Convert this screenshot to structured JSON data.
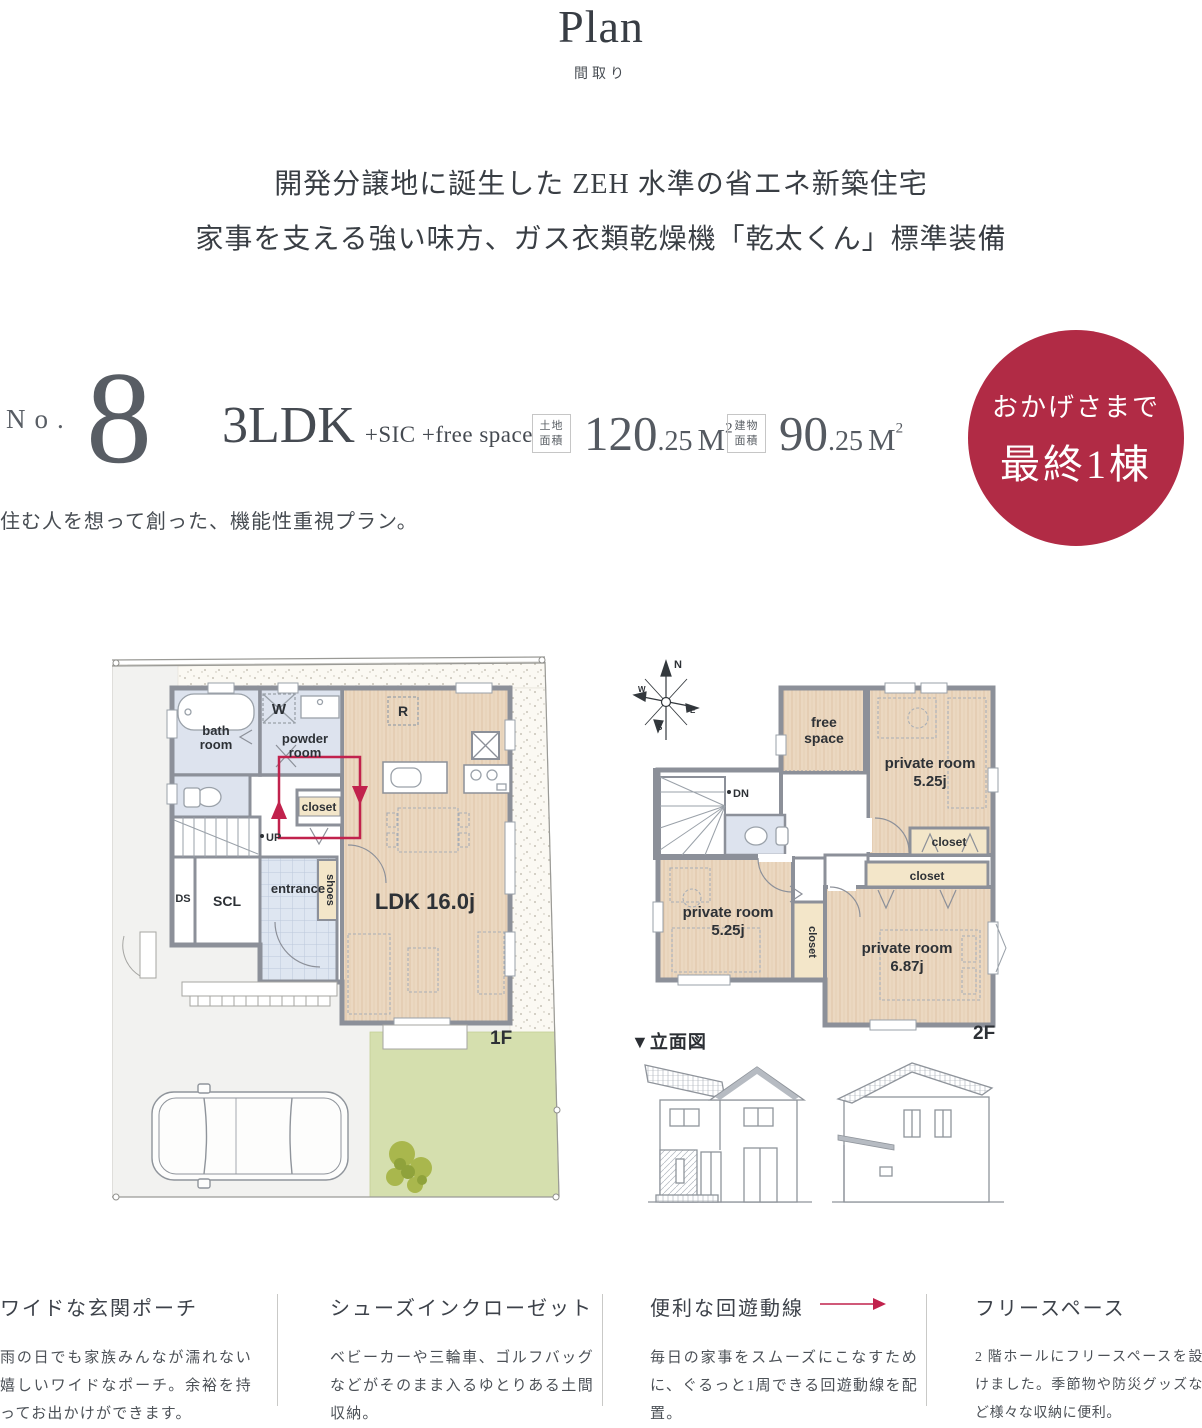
{
  "header": {
    "title": "Plan",
    "subtitle": "間取り",
    "lead1": "開発分譲地に誕生した ZEH 水準の省エネ新築住宅",
    "lead2": "家事を支える強い味方、ガス衣類乾燥機「乾太くん」標準装備"
  },
  "plan": {
    "no_label": "No.",
    "no_value": "8",
    "type": "3LDK",
    "type_suffix": "+SIC +free space",
    "land": {
      "label1": "土地",
      "label2": "面積",
      "int": "120",
      "dec": ".25",
      "unit": "M",
      "sup": "2"
    },
    "building": {
      "label1": "建物",
      "label2": "面積",
      "int": "90",
      "dec": ".25",
      "unit": "M",
      "sup": "2"
    },
    "badge": {
      "line1": "おかげさまで",
      "line2": "最終1棟",
      "color": "#b12b45"
    },
    "tagline": "住む人を想って創った、機能性重視プラン。"
  },
  "floor1": {
    "labels": {
      "bath1": "bath",
      "bath2": "room",
      "w": "W",
      "powder1": "powder",
      "powder2": "room",
      "closet": "closet",
      "up": "UP",
      "ds": "DS",
      "scl": "SCL",
      "entrance": "entrance",
      "shoes": "shoes",
      "ldk": "LDK 16.0j",
      "r": "R",
      "floor": "1F"
    }
  },
  "floor2": {
    "labels": {
      "free1": "free",
      "free2": "space",
      "p1a": "private room",
      "p1b": "5.25j",
      "closet1": "closet",
      "closet2": "closet",
      "p2a": "private room",
      "p2b": "5.25j",
      "p3a": "private room",
      "p3b": "6.87j",
      "dn": "DN",
      "floor": "2F"
    },
    "compass": {
      "n": "N",
      "e": "E",
      "w": "W",
      "s": "S"
    }
  },
  "elevation": {
    "label": "▼立面図"
  },
  "features": [
    {
      "title": "ワイドな玄関ポーチ",
      "body": "雨の日でも家族みんなが濡れない嬉しいワイドなポーチ。余裕を持ってお出かけができます。"
    },
    {
      "title": "シューズインクローゼット",
      "body": "ベビーカーや三輪車、ゴルフバッグなどがそのまま入るゆとりある土間収納。"
    },
    {
      "title": "便利な回遊動線",
      "body": "毎日の家事をスムーズにこなすために、ぐるっと1周できる回遊動線を配置。"
    },
    {
      "title": "フリースペース",
      "body": "2 階ホールにフリースペースを設けました。季節物や防災グッズなど様々な収納に便利。"
    }
  ],
  "colors": {
    "accent_red": "#b12b45",
    "flow_red": "#c1224d",
    "wall": "#8c9099",
    "room_blue": "#dde3ee",
    "floor_tan": "#ebd8c1",
    "closet_cream": "#f3e6c9",
    "garden_green": "#d5dfae"
  }
}
